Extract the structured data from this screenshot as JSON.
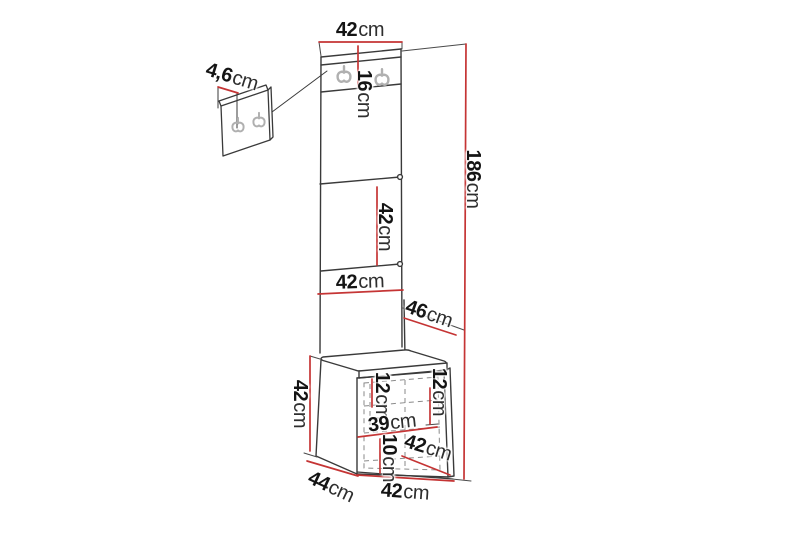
{
  "drawing": {
    "type": "furniture-dimension-diagram",
    "subject": "hallway storage column with coat-hook panels and bench cabinet",
    "unit": "cm",
    "colors": {
      "dimension_red": "#c53434",
      "outline": "#3a3a3a",
      "hook_gray": "#b0b0b0",
      "dashed_gray": "#8a8a8a",
      "background": "#ffffff"
    }
  },
  "dims": {
    "top_width": {
      "value": "42",
      "unit": "cm"
    },
    "hook_panel_height": {
      "value": "16",
      "unit": "cm"
    },
    "wall_panel_depth": {
      "value": "4,6",
      "unit": "cm"
    },
    "total_height": {
      "value": "186",
      "unit": "cm"
    },
    "mid_panel_height": {
      "value": "42",
      "unit": "cm"
    },
    "panel_width": {
      "value": "42",
      "unit": "cm"
    },
    "unit_depth": {
      "value": "46",
      "unit": "cm"
    },
    "bench_height": {
      "value": "42",
      "unit": "cm"
    },
    "door_inset_left": {
      "value": "12",
      "unit": "cm"
    },
    "door_inset_right": {
      "value": "12",
      "unit": "cm"
    },
    "inner_width": {
      "value": "39",
      "unit": "cm"
    },
    "plinth_height": {
      "value": "10",
      "unit": "cm"
    },
    "seat_depth": {
      "value": "42",
      "unit": "cm"
    },
    "bench_depth": {
      "value": "44",
      "unit": "cm"
    },
    "bench_width": {
      "value": "42",
      "unit": "cm"
    }
  }
}
